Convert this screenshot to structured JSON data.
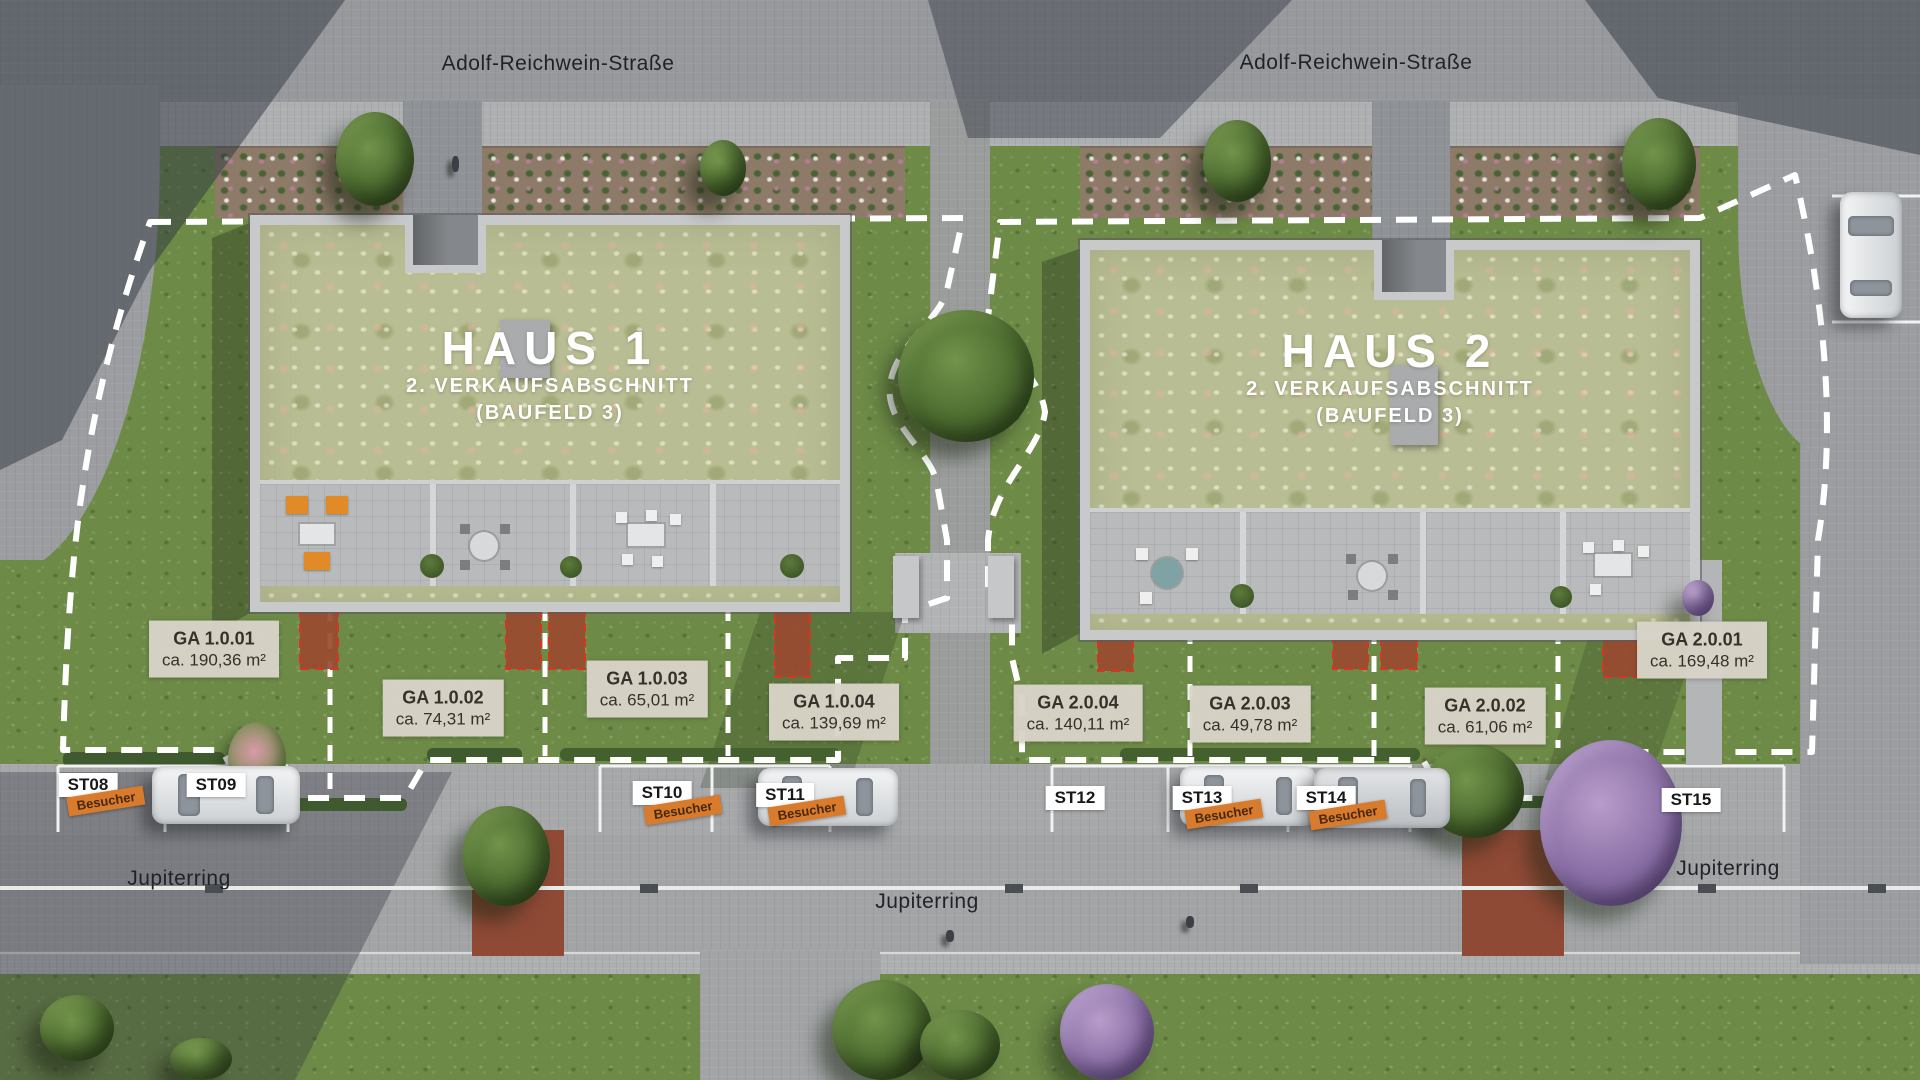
{
  "streets": {
    "top_left": "Adolf-Reichwein-Straße",
    "top_right": "Adolf-Reichwein-Straße",
    "bottom_left": "Jupiterring",
    "bottom_center": "Jupiterring",
    "bottom_right": "Jupiterring"
  },
  "buildings": [
    {
      "name": "HAUS 1",
      "line1": "2. VERKAUFSABSCHNITT",
      "line2": "(BAUFELD 3)"
    },
    {
      "name": "HAUS 2",
      "line1": "2. VERKAUFSABSCHNITT",
      "line2": "(BAUFELD 3)"
    }
  ],
  "garden_areas": [
    {
      "id": "GA 1.0.01",
      "area": "ca. 190,36 m²"
    },
    {
      "id": "GA 1.0.02",
      "area": "ca. 74,31 m²"
    },
    {
      "id": "GA 1.0.03",
      "area": "ca. 65,01 m²"
    },
    {
      "id": "GA 1.0.04",
      "area": "ca. 139,69 m²"
    },
    {
      "id": "GA 2.0.04",
      "area": "ca. 140,11 m²"
    },
    {
      "id": "GA 2.0.03",
      "area": "ca. 49,78 m²"
    },
    {
      "id": "GA 2.0.02",
      "area": "ca. 61,06 m²"
    },
    {
      "id": "GA 2.0.01",
      "area": "ca. 169,48 m²"
    }
  ],
  "parking_spots": [
    {
      "id": "ST08",
      "tag": "Besucher"
    },
    {
      "id": "ST09",
      "tag": ""
    },
    {
      "id": "ST10",
      "tag": "Besucher"
    },
    {
      "id": "ST11",
      "tag": "Besucher"
    },
    {
      "id": "ST12",
      "tag": ""
    },
    {
      "id": "ST13",
      "tag": "Besucher"
    },
    {
      "id": "ST14",
      "tag": "Besucher"
    },
    {
      "id": "ST15",
      "tag": ""
    }
  ],
  "colors": {
    "label_bg": "#d9d3c8",
    "label_text": "#35322b",
    "visitor_bg": "#d97b2c",
    "boundary_dash": "#ffffff",
    "red_patch": "#9a4a30",
    "red_patch_border": "#d93420",
    "roof_green": "#b9bd93",
    "grass": "#6d8a47",
    "road": "#a2a4a6",
    "title_text": "#ffffff"
  }
}
